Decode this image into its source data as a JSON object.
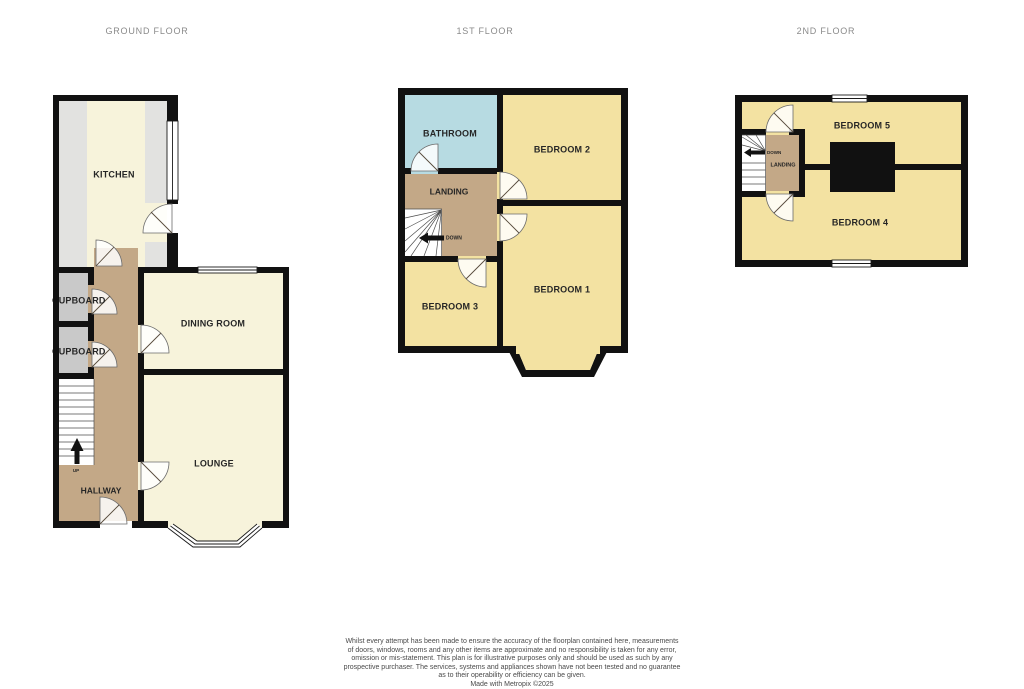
{
  "titles": {
    "ground_floor": "GROUND FLOOR",
    "first_floor": "1ST FLOOR",
    "second_floor": "2ND FLOOR"
  },
  "ground_floor": {
    "kitchen_label": "KITCHEN",
    "cupboard_top_label": "CUPBOARD",
    "cupboard_bottom_label": "CUPBOARD",
    "dining_room_label": "DINING ROOM",
    "lounge_label": "LOUNGE",
    "hallway_label": "HALLWAY",
    "stairs_label": "UP"
  },
  "first_floor": {
    "bathroom_label": "BATHROOM",
    "bedroom2_label": "BEDROOM 2",
    "landing_label": "LANDING",
    "stairs_label": "DOWN",
    "bedroom3_label": "BEDROOM 3",
    "bedroom1_label": "BEDROOM 1"
  },
  "second_floor": {
    "bedroom5_label": "BEDROOM 5",
    "bedroom4_label": "BEDROOM 4",
    "landing_label": "LANDING",
    "stairs_label": "DOWN"
  },
  "disclaimer": {
    "lines": [
      "Whilst every attempt has been made to ensure the accuracy of the floorplan contained here, measurements",
      "of doors, windows, rooms and any other items are approximate and no responsibility is taken for any error,",
      "omission or mis-statement. This plan is for illustrative purposes only and should be used as such by any",
      "prospective purchaser. The services, systems and appliances shown have not been tested and no guarantee",
      "as to their operability or efficiency can be given.",
      "Made with Metropix ©2025"
    ]
  },
  "colors": {
    "wall": "#111111",
    "floor_cream": "#F7F3DB",
    "bedroom_yellow": "#F3E2A2",
    "bathroom_blue": "#B7DBE2",
    "hallway_tan": "#C3A887",
    "counter_gray": "#E2E2E0",
    "cupboard_gray": "#C9C9C9",
    "title_gray": "#8A8A8A"
  }
}
